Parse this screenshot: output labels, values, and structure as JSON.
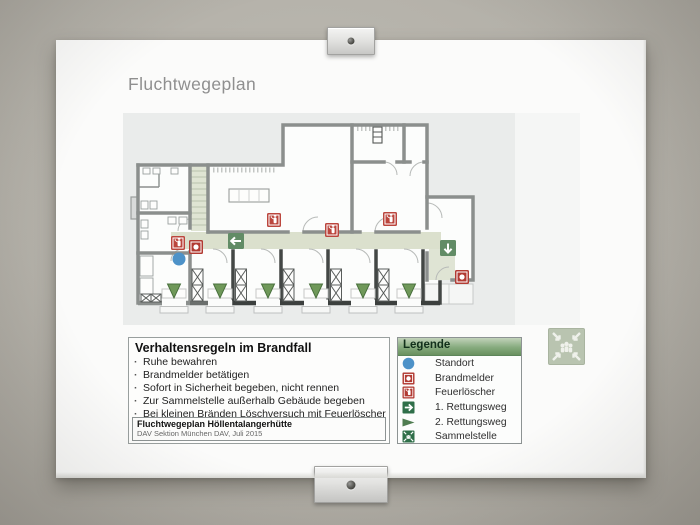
{
  "poster": {
    "title": "Fluchtwegeplan"
  },
  "rules": {
    "title": "Verhaltensregeln im Brandfall",
    "items": [
      "Ruhe bewahren",
      "Brandmelder betätigen",
      "Sofort in Sicherheit begeben, nicht rennen",
      "Zur Sammelstelle außerhalb Gebäude begeben",
      "Bei kleinen Bränden Löschversuch mit Feuerlöscher"
    ],
    "footer_title": "Fluchtwegeplan Höllentalangerhütte",
    "footer_subtitle": "DAV Sektion München DAV,  Juli 2015"
  },
  "legend": {
    "title": "Legende",
    "items": [
      {
        "icon": "standort-icon",
        "label": "Standort",
        "color": "#4d92c8"
      },
      {
        "icon": "brandmelder-icon",
        "label": "Brandmelder",
        "color": "#b23b33"
      },
      {
        "icon": "feuerloescher-icon",
        "label": "Feuerlöscher",
        "color": "#b23b33"
      },
      {
        "icon": "rettungsweg-1-icon",
        "label": "1. Rettungsweg",
        "color": "#2f6f49"
      },
      {
        "icon": "rettungsweg-2-icon",
        "label": "2. Rettungsweg",
        "color": "#4f7d51"
      },
      {
        "icon": "sammelstelle-icon",
        "label": "Sammelstelle",
        "color": "#2f6f49"
      }
    ]
  },
  "plan": {
    "corridor_color": "#dbe0cd",
    "wall_color": "#8b8f8d",
    "markers": [
      {
        "type": "feuerloescher",
        "name": "fire-extinguisher-icon",
        "x": 55,
        "y": 130
      },
      {
        "type": "brandmelder",
        "name": "fire-alarm-icon",
        "x": 73,
        "y": 134
      },
      {
        "type": "standort",
        "name": "you-are-here-icon",
        "x": 56,
        "y": 146
      },
      {
        "type": "sign-left",
        "name": "escape-route-left-icon",
        "x": 113,
        "y": 128
      },
      {
        "type": "feuerloescher",
        "name": "fire-extinguisher-icon",
        "x": 151,
        "y": 107
      },
      {
        "type": "feuerloescher",
        "name": "fire-extinguisher-icon",
        "x": 209,
        "y": 117
      },
      {
        "type": "feuerloescher",
        "name": "fire-extinguisher-icon",
        "x": 267,
        "y": 106
      },
      {
        "type": "sign-down",
        "name": "escape-route-down-icon",
        "x": 325,
        "y": 135
      },
      {
        "type": "brandmelder",
        "name": "fire-alarm-icon",
        "x": 339,
        "y": 164
      },
      {
        "type": "triangle-down",
        "name": "secondary-escape-icon",
        "x": 51,
        "y": 178
      },
      {
        "type": "triangle-down",
        "name": "secondary-escape-icon",
        "x": 97,
        "y": 178
      },
      {
        "type": "triangle-down",
        "name": "secondary-escape-icon",
        "x": 145,
        "y": 178
      },
      {
        "type": "triangle-down",
        "name": "secondary-escape-icon",
        "x": 193,
        "y": 178
      },
      {
        "type": "triangle-down",
        "name": "secondary-escape-icon",
        "x": 240,
        "y": 178
      },
      {
        "type": "triangle-down",
        "name": "secondary-escape-icon",
        "x": 286,
        "y": 178
      }
    ]
  }
}
